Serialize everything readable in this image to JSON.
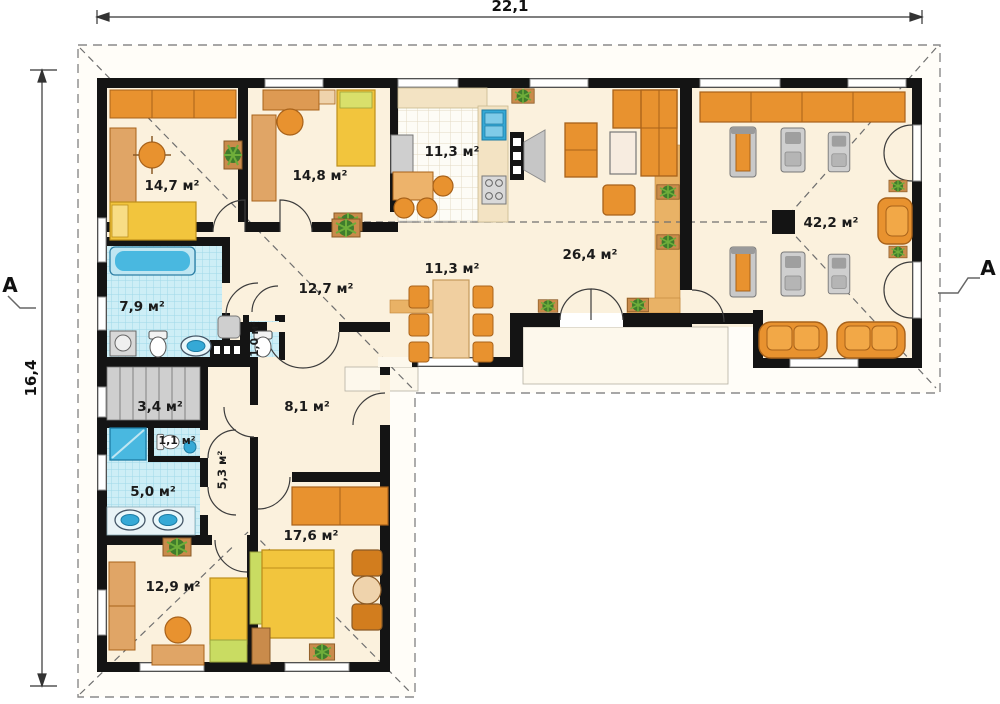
{
  "plan": {
    "type": "floor-plan",
    "dimensions": {
      "width_label": "22,1",
      "height_label": "16,4"
    },
    "section_markers": {
      "left": "A",
      "right": "A"
    },
    "rooms": [
      {
        "id": "bedroom-top-left",
        "area": "14,7 м²"
      },
      {
        "id": "bedroom-top-mid",
        "area": "14,8 м²"
      },
      {
        "id": "kitchen",
        "area": "11,3 м²"
      },
      {
        "id": "corridor",
        "area": "12,7 м²"
      },
      {
        "id": "dining",
        "area": "11,3 м²"
      },
      {
        "id": "living-room",
        "area": "26,4 м²"
      },
      {
        "id": "family-gym-room",
        "area": "42,2 м²"
      },
      {
        "id": "bathroom",
        "area": "7,9 м²"
      },
      {
        "id": "wc-small",
        "area": "1,0 м²"
      },
      {
        "id": "stairs",
        "area": "3,4 м²"
      },
      {
        "id": "wc",
        "area": "1,1 м²"
      },
      {
        "id": "shower-room",
        "area": "5,0 м²"
      },
      {
        "id": "hallway",
        "area": "5,3 м²"
      },
      {
        "id": "vestibule",
        "area": "8,1 м²"
      },
      {
        "id": "bedroom-bottom-left",
        "area": "12,9 м²"
      },
      {
        "id": "bedroom-bottom",
        "area": "17,6 м²"
      }
    ],
    "colors": {
      "wall": "#141414",
      "floor_cream": "#fbf1dd",
      "terrace": "#fdf8ec",
      "furniture_orange": "#e8922f",
      "furniture_orange_dark": "#b06212",
      "bed_yellow": "#f2c53d",
      "accent_green": "#c9dc62",
      "tile_blue": "#cdeef6",
      "fixture_blue": "#35a9d6",
      "gray": "#bdbdbd"
    }
  }
}
